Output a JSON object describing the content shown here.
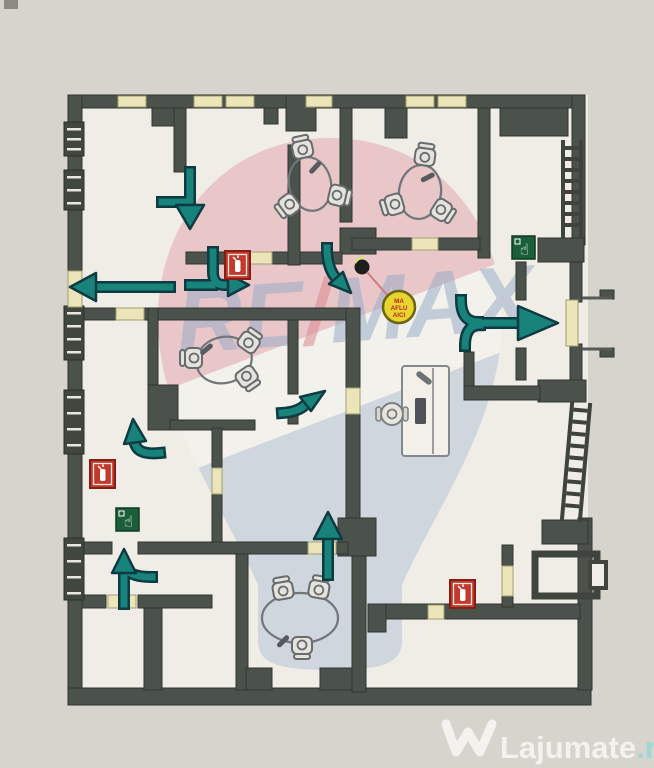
{
  "page": {
    "background": "#d7d4ce"
  },
  "plan": {
    "floor_color": "#f0ede6",
    "wall_color": "#4b514b",
    "window_color": "#ebe5b9",
    "arrow_color": "#17837b",
    "you_are_here": {
      "lines": [
        "MA",
        "AFLU",
        "AICI"
      ],
      "bg": "#e6d42f",
      "text_color": "#c42420"
    },
    "icons": {
      "fire_extinguisher": {
        "label": "fire-extinguisher",
        "color": "#c23a2b",
        "count": 3
      },
      "manual_call_point": {
        "label": "manual-call-point",
        "color": "#1a5f3a",
        "count": 2,
        "glyph": "☝"
      }
    },
    "furniture": {
      "round_tables": 4,
      "desks": 1,
      "staircases": 2
    }
  },
  "watermarks": {
    "remax": {
      "left": "RE",
      "slash": "/",
      "right": "MAX",
      "letter_color": "#93a9c8",
      "slash_color": "#d8828b"
    },
    "lajumate": {
      "brand": "Lajumate",
      "tld": ".ro",
      "brand_color": "#f3f2ee",
      "tld_color": "#9ed6d2"
    }
  }
}
